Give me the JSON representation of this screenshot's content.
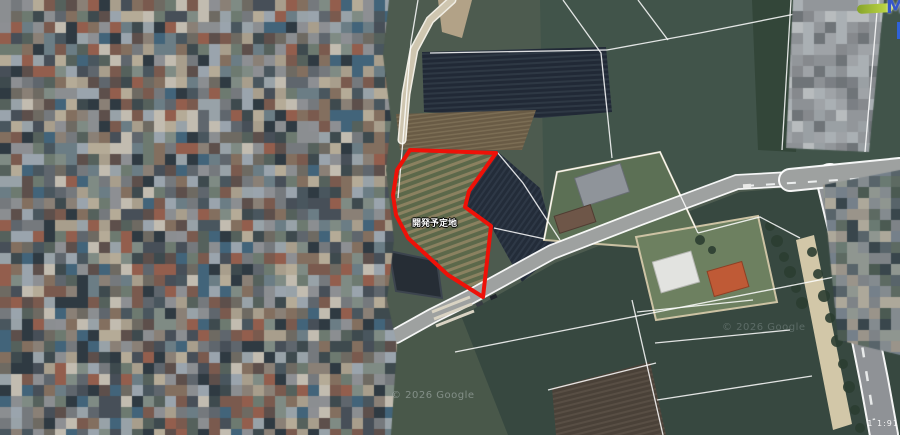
{
  "meta": {
    "width": 900,
    "height": 435,
    "view": "satellite-aerial"
  },
  "colors": {
    "parcel_outline": "#ee1108",
    "base_field": "#4d5b4f",
    "road_fill": "#9ea1a0",
    "cadastral_line": "rgba(255,255,255,0.85)",
    "logo_blue": "#3556c9",
    "logo_green": "#c8e04a"
  },
  "map": {
    "label": {
      "text": "開発予定地",
      "x": 412,
      "y": 219
    },
    "watermarks": [
      {
        "text": "© 2026 Google"
      },
      {
        "text": "© 2026 Google"
      }
    ],
    "scale_text": {
      "text": "1 1:91"
    },
    "logo": {
      "letter": "M"
    },
    "parcel": {
      "stroke": "#ee1108",
      "stroke_width": 4,
      "points": [
        [
          410,
          150
        ],
        [
          496,
          153
        ],
        [
          469,
          191
        ],
        [
          465,
          207
        ],
        [
          491,
          226
        ],
        [
          483,
          297
        ],
        [
          448,
          275
        ],
        [
          408,
          238
        ],
        [
          396,
          215
        ],
        [
          393,
          195
        ],
        [
          397,
          170
        ]
      ]
    },
    "fields": [
      {
        "name": "base-ground",
        "points": [
          [
            370,
            0
          ],
          [
            900,
            0
          ],
          [
            900,
            435
          ],
          [
            370,
            435
          ]
        ],
        "fill": "#4d5b4f"
      },
      {
        "name": "field-top-right-green",
        "points": [
          [
            540,
            0
          ],
          [
            900,
            0
          ],
          [
            900,
            163
          ],
          [
            737,
            175
          ],
          [
            640,
            213
          ],
          [
            545,
            252
          ]
        ],
        "fill": "#41544a"
      },
      {
        "name": "tree-band-top-right",
        "points": [
          [
            752,
            0
          ],
          [
            806,
            0
          ],
          [
            796,
            152
          ],
          [
            758,
            150
          ]
        ],
        "fill": "#334639"
      },
      {
        "name": "bare-tan-patch-top",
        "points": [
          [
            438,
            0
          ],
          [
            472,
            0
          ],
          [
            462,
            38
          ],
          [
            442,
            32
          ]
        ],
        "fill": "#b2a287"
      },
      {
        "name": "dark-orchard-field",
        "points": [
          [
            422,
            52
          ],
          [
            606,
            47
          ],
          [
            612,
            112
          ],
          [
            540,
            118
          ],
          [
            424,
            112
          ]
        ],
        "fill": "#212936",
        "stripes": {
          "color": "#2e3844",
          "gap": 5,
          "width": 2,
          "angle": -3
        }
      },
      {
        "name": "brown-row-strip",
        "points": [
          [
            396,
            114
          ],
          [
            536,
            110
          ],
          [
            522,
            150
          ],
          [
            400,
            150
          ]
        ],
        "fill": "#695b45",
        "stripes": {
          "color": "#7b6d54",
          "gap": 4,
          "width": 1.5,
          "angle": -7
        }
      },
      {
        "name": "parcel-interior-rows",
        "points": [
          [
            410,
            150
          ],
          [
            496,
            153
          ],
          [
            469,
            191
          ],
          [
            465,
            207
          ],
          [
            491,
            226
          ],
          [
            483,
            297
          ],
          [
            448,
            275
          ],
          [
            408,
            238
          ],
          [
            396,
            215
          ],
          [
            393,
            195
          ],
          [
            397,
            170
          ]
        ],
        "fill": "#5c684a",
        "stripes": {
          "color": "#8a8160",
          "gap": 7,
          "width": 3,
          "angle": -20
        }
      },
      {
        "name": "dark-diagonal-field",
        "points": [
          [
            497,
            151
          ],
          [
            468,
            192
          ],
          [
            464,
            208
          ],
          [
            492,
            228
          ],
          [
            522,
            282
          ],
          [
            558,
            252
          ],
          [
            540,
            188
          ]
        ],
        "fill": "#232c39",
        "stripes": {
          "color": "#2e3846",
          "gap": 5,
          "width": 2,
          "angle": -55
        }
      },
      {
        "name": "bottom-dark-fields",
        "points": [
          [
            388,
            352
          ],
          [
            475,
            308
          ],
          [
            555,
            263
          ],
          [
            645,
            228
          ],
          [
            740,
            192
          ],
          [
            900,
            178
          ],
          [
            900,
            435
          ],
          [
            388,
            435
          ]
        ],
        "fill": "#374840"
      },
      {
        "name": "bottom-left-patch",
        "points": [
          [
            390,
            342
          ],
          [
            462,
            318
          ],
          [
            508,
            435
          ],
          [
            390,
            435
          ]
        ],
        "fill": "#49584a"
      },
      {
        "name": "brown-field-bottom",
        "points": [
          [
            552,
            388
          ],
          [
            650,
            362
          ],
          [
            666,
            435
          ],
          [
            556,
            435
          ]
        ],
        "fill": "#4a4138",
        "stripes": {
          "color": "#584e44",
          "gap": 5,
          "width": 2,
          "angle": -14
        }
      },
      {
        "name": "houses-lot",
        "points": [
          [
            544,
            240
          ],
          [
            557,
            172
          ],
          [
            660,
            152
          ],
          [
            698,
            233
          ],
          [
            652,
            248
          ]
        ],
        "fill": "#5c7055",
        "stroke": "#c9c0a2"
      },
      {
        "name": "buildings-lot",
        "points": [
          [
            636,
            237
          ],
          [
            758,
            216
          ],
          [
            777,
            302
          ],
          [
            656,
            320
          ]
        ],
        "fill": "#6d8060",
        "stroke": "#cdc3a4"
      },
      {
        "name": "tan-roadside-strip",
        "points": [
          [
            796,
            240
          ],
          [
            814,
            235
          ],
          [
            852,
            424
          ],
          [
            833,
            430
          ]
        ],
        "fill": "#d2c7a8"
      },
      {
        "name": "dark-roof-structure",
        "points": [
          [
            389,
            251
          ],
          [
            437,
            261
          ],
          [
            442,
            298
          ],
          [
            396,
            291
          ]
        ],
        "fill": "#262d35",
        "stroke": "#3c444e"
      }
    ],
    "roads": [
      {
        "name": "tan-road-top",
        "points": [
          [
            452,
            0
          ],
          [
            430,
            20
          ],
          [
            414,
            50
          ],
          [
            406,
            94
          ],
          [
            402,
            140
          ]
        ],
        "casing": "#f0ede4",
        "casing_w": 9,
        "fill": "#cfc6b0",
        "fill_w": 6
      },
      {
        "name": "right-vertical-road",
        "points": [
          [
            830,
            178
          ],
          [
            845,
            240
          ],
          [
            862,
            320
          ],
          [
            874,
            380
          ],
          [
            884,
            435
          ]
        ],
        "casing": "rgba(255,255,255,0.95)",
        "casing_w": 30,
        "fill": "#8f9296",
        "fill_w": 26,
        "dash": {
          "points": [
            [
              838,
              230
            ],
            [
              858,
              320
            ],
            [
              874,
              420
            ]
          ],
          "pattern": "10 14",
          "width": 2.5,
          "color": "#e8eaea"
        }
      },
      {
        "name": "main-diagonal-road",
        "points": [
          [
            900,
            168
          ],
          [
            810,
            178
          ],
          [
            737,
            182
          ],
          [
            640,
            218
          ],
          [
            552,
            252
          ],
          [
            470,
            297
          ],
          [
            432,
            316
          ],
          [
            396,
            336
          ]
        ],
        "casing": "rgba(255,255,255,0.95)",
        "casing_w": 16,
        "fill": "#9ea1a0",
        "fill_w": 12.5
      },
      {
        "name": "main-road-wide-east",
        "points": [
          [
            900,
            169
          ],
          [
            790,
            180
          ]
        ],
        "casing": "rgba(255,255,255,0.95)",
        "casing_w": 24,
        "fill": "#9ea1a0",
        "fill_w": 20,
        "dash": {
          "points": [
            [
              745,
              186
            ],
            [
              900,
              176
            ]
          ],
          "pattern": "9 12",
          "width": 2,
          "color": "#eceeee"
        }
      }
    ],
    "greenhouse_lines": [
      {
        "points": [
          [
            432,
            312
          ],
          [
            470,
            297
          ]
        ]
      },
      {
        "points": [
          [
            434,
            319
          ],
          [
            472,
            304
          ]
        ]
      },
      {
        "points": [
          [
            436,
            326
          ],
          [
            474,
            311
          ]
        ]
      }
    ],
    "cadastral_lines": [
      {
        "points": [
          [
            418,
            0
          ],
          [
            411,
            42
          ],
          [
            407,
            90
          ],
          [
            403,
            140
          ]
        ]
      },
      {
        "points": [
          [
            403,
            140
          ],
          [
            398,
            198
          ]
        ]
      },
      {
        "points": [
          [
            563,
            0
          ],
          [
            601,
            53
          ],
          [
            607,
            110
          ],
          [
            612,
            158
          ]
        ]
      },
      {
        "points": [
          [
            430,
            53
          ],
          [
            607,
            50
          ]
        ]
      },
      {
        "points": [
          [
            607,
            50
          ],
          [
            700,
            33
          ],
          [
            800,
            13
          ],
          [
            838,
            0
          ]
        ]
      },
      {
        "points": [
          [
            638,
            0
          ],
          [
            668,
            40
          ]
        ]
      },
      {
        "points": [
          [
            497,
            152
          ],
          [
            523,
            183
          ],
          [
            560,
            240
          ]
        ]
      },
      {
        "points": [
          [
            494,
            228
          ],
          [
            545,
            239
          ]
        ]
      },
      {
        "points": [
          [
            544,
            240
          ],
          [
            557,
            172
          ],
          [
            660,
            152
          ],
          [
            698,
            233
          ]
        ]
      },
      {
        "points": [
          [
            698,
            233
          ],
          [
            760,
            217
          ],
          [
            800,
            238
          ]
        ]
      },
      {
        "points": [
          [
            455,
            352
          ],
          [
            642,
            315
          ],
          [
            900,
            264
          ]
        ]
      },
      {
        "points": [
          [
            632,
            300
          ],
          [
            663,
            435
          ]
        ]
      },
      {
        "points": [
          [
            637,
            312
          ],
          [
            753,
            300
          ]
        ]
      },
      {
        "points": [
          [
            655,
            343
          ],
          [
            790,
            330
          ]
        ]
      },
      {
        "points": [
          [
            657,
            400
          ],
          [
            812,
            376
          ]
        ]
      },
      {
        "points": [
          [
            548,
            390
          ],
          [
            656,
            363
          ]
        ]
      }
    ],
    "top_lines": [
      {
        "points": [
          [
            791,
            0
          ],
          [
            782,
            150
          ]
        ]
      },
      {
        "points": [
          [
            878,
            0
          ],
          [
            865,
            152
          ]
        ]
      }
    ],
    "buildings": [
      {
        "name": "gray-roof-house",
        "x": 578,
        "y": 170,
        "w": 48,
        "h": 30,
        "rot": -18,
        "fill": "#8f949a",
        "stroke": "#686d73"
      },
      {
        "name": "brown-roof-shed",
        "x": 556,
        "y": 210,
        "w": 38,
        "h": 18,
        "rot": -18,
        "fill": "#6e5648",
        "stroke": "#503c32"
      },
      {
        "name": "white-building",
        "x": 656,
        "y": 256,
        "w": 40,
        "h": 32,
        "rot": -16,
        "fill": "#e2e3e0",
        "stroke": "#b5b6b2"
      },
      {
        "name": "orange-roof-building",
        "x": 710,
        "y": 266,
        "w": 36,
        "h": 26,
        "rot": -16,
        "fill": "#bf5a36",
        "stroke": "#8e3f24"
      }
    ],
    "cars": [
      {
        "x": 476,
        "y": 302,
        "w": 7,
        "h": 4,
        "rot": -24,
        "fill": "#383d43"
      },
      {
        "x": 490,
        "y": 295,
        "w": 7,
        "h": 4,
        "rot": -24,
        "fill": "#21262c"
      },
      {
        "x": 743,
        "y": 184,
        "w": 8,
        "h": 4,
        "rot": -4,
        "fill": "#e9e9e7"
      }
    ],
    "trees": [
      [
        770,
        226,
        5
      ],
      [
        777,
        241,
        6
      ],
      [
        784,
        257,
        5
      ],
      [
        790,
        272,
        6
      ],
      [
        796,
        288,
        5
      ],
      [
        802,
        303,
        6
      ],
      [
        700,
        240,
        5
      ],
      [
        712,
        250,
        4
      ],
      [
        856,
        190,
        5
      ],
      [
        872,
        187,
        5
      ],
      [
        889,
        184,
        5
      ],
      [
        836,
        196,
        4
      ],
      [
        812,
        252,
        5
      ],
      [
        818,
        274,
        5
      ],
      [
        824,
        296,
        6
      ],
      [
        830,
        318,
        5
      ],
      [
        837,
        341,
        6
      ],
      [
        843,
        364,
        5
      ],
      [
        849,
        387,
        6
      ],
      [
        855,
        410,
        5
      ],
      [
        860,
        428,
        5
      ]
    ],
    "tree_color": "#2b3d31"
  },
  "mosaic": {
    "cell": 11,
    "areas": [
      {
        "name": "blurred-residential-area",
        "seed": 7,
        "clip": [
          [
            0,
            0
          ],
          [
            389,
            0
          ],
          [
            383,
            55
          ],
          [
            391,
            120
          ],
          [
            386,
            170
          ],
          [
            394,
            240
          ],
          [
            387,
            300
          ],
          [
            397,
            345
          ],
          [
            391,
            435
          ],
          [
            0,
            435
          ]
        ],
        "palette": [
          "#8b8e91",
          "#75797d",
          "#5f666d",
          "#474f58",
          "#6e6a62",
          "#8a8076",
          "#a89e8c",
          "#c2bcb0",
          "#6d7a70",
          "#55615c",
          "#3e4a4e",
          "#5d4f4b",
          "#7a5a4e",
          "#935e4d",
          "#42647a",
          "#98a2a8",
          "#b5ab97",
          "#2f3a42",
          "#836f5f",
          "#6b7d85",
          "#49565e",
          "#7f8b84",
          "#9aa4ad",
          "#8d8f93"
        ]
      },
      {
        "name": "blurred-road-top-right",
        "seed": 13,
        "clip": [
          [
            793,
            0
          ],
          [
            884,
            0
          ],
          [
            869,
            152
          ],
          [
            786,
            148
          ]
        ],
        "palette": [
          "#92969a",
          "#9fa3a7",
          "#86898d",
          "#aab0b4",
          "#7b7f84",
          "#b8bcbe",
          "#6f7478",
          "#9aa0a4",
          "#8d9195"
        ]
      },
      {
        "name": "blurred-buildings-right",
        "seed": 21,
        "clip": [
          [
            823,
            185
          ],
          [
            900,
            170
          ],
          [
            900,
            355
          ],
          [
            838,
            340
          ]
        ],
        "palette": [
          "#7e8387",
          "#6a7a72",
          "#8f9690",
          "#58646a",
          "#9a948a",
          "#4b5a52",
          "#848b8f",
          "#ada89a",
          "#39464c",
          "#75808a",
          "#5d6a62"
        ]
      }
    ]
  }
}
